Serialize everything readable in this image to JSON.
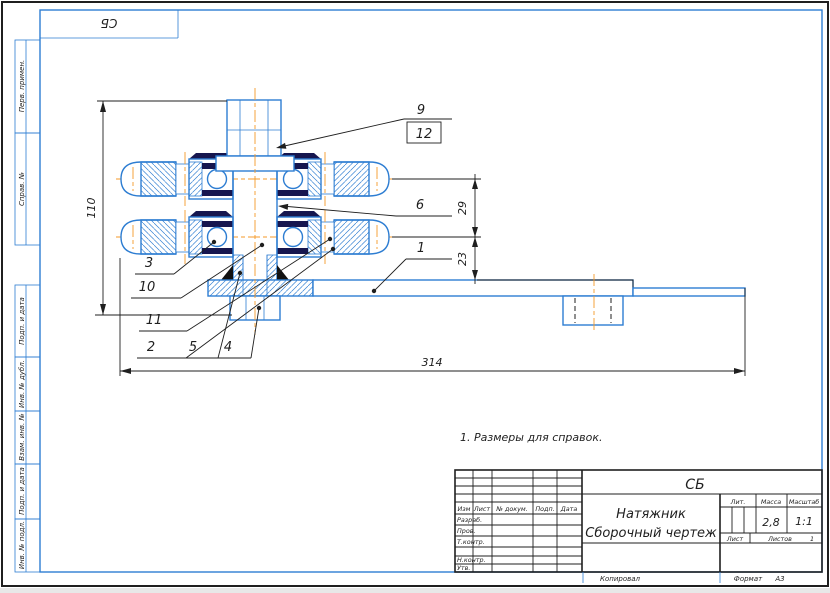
{
  "sheet": {
    "corner_stamp": "СБ",
    "margin_labels": [
      "Перв. примен.",
      "Справ. №",
      "Подп. и дата",
      "Инв. № дубл.",
      "Взам. инв. №",
      "Подп. и дата",
      "Инв. № подл."
    ],
    "footer": {
      "copied": "Копировал",
      "format_label": "Формат",
      "format_value": "А3"
    }
  },
  "note": "1. Размеры для справок.",
  "dimensions": {
    "height": "110",
    "upper": "29",
    "lower": "23",
    "length": "314"
  },
  "callouts": {
    "c9": "9",
    "c12": "12",
    "c6": "6",
    "c1": "1",
    "c3": "3",
    "c10": "10",
    "c11": "11",
    "c2": "2",
    "c5": "5",
    "c4": "4"
  },
  "title_block": {
    "designation": "СБ",
    "name_line1": "Натяжник",
    "name_line2": "Сборочный чертеж",
    "header_cols": {
      "izm": "Изм",
      "list": "Лист",
      "doc": "№ докум.",
      "sign": "Подп.",
      "date": "Дата"
    },
    "rows": {
      "developed": "Разраб.",
      "checked": "Пров.",
      "tcontrol": "Т.контр.",
      "ncontrol": "Н.контр.",
      "approved": "Утв."
    },
    "lit_label": "Лит.",
    "mass_label": "Масса",
    "scale_label": "Масштаб",
    "mass_value": "2,8",
    "scale_value": "1:1",
    "sheet_label": "Лист",
    "sheets_label": "Листов",
    "sheets_value": "1"
  },
  "colors": {
    "outline_blue": "#2d7dd2",
    "centerline_orange": "#f59a28",
    "drawing_black": "#1f1f1f",
    "bearing_dark": "#16164f"
  }
}
